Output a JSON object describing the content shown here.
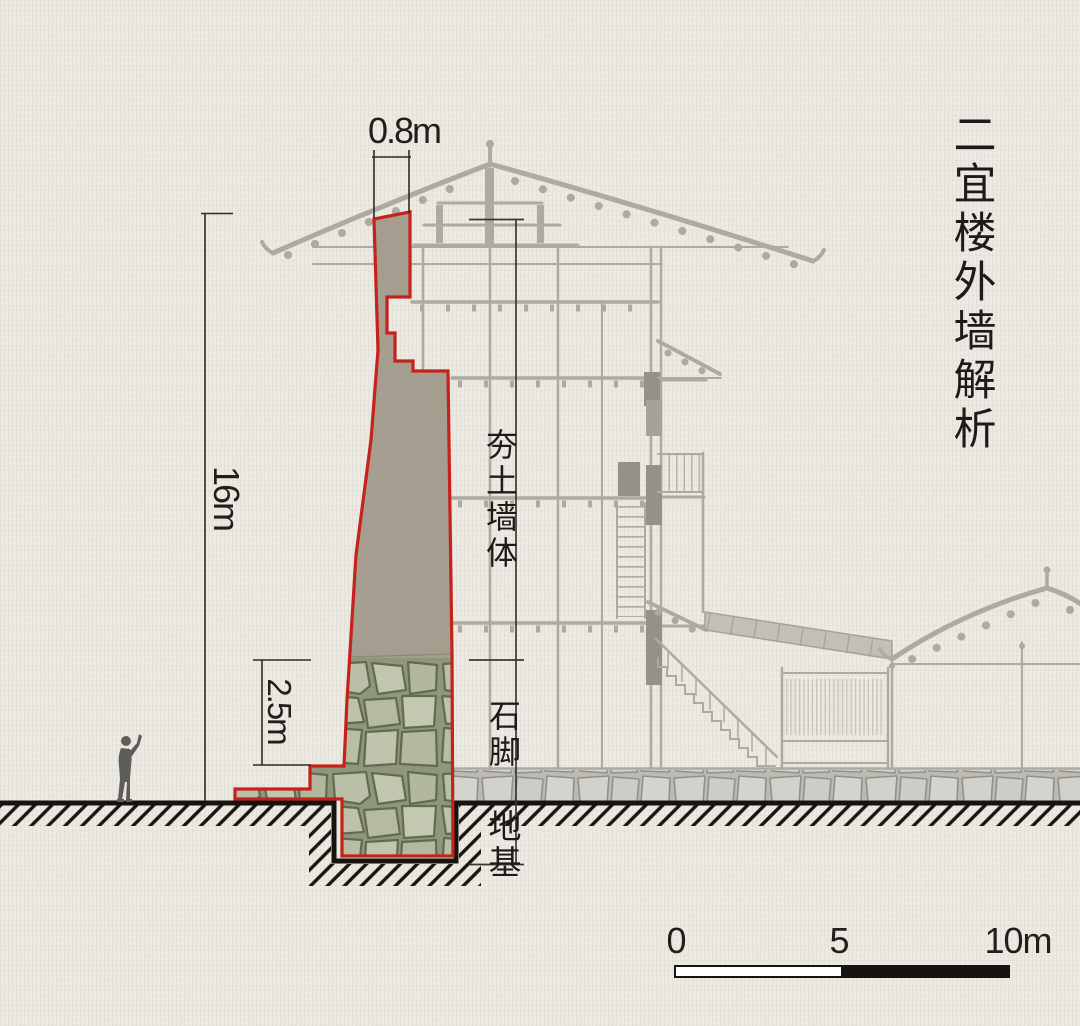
{
  "title": "二宜楼外墙解析",
  "wall": {
    "top_width": "0.8m",
    "height": "16m",
    "stone_foot_height": "2.5m",
    "layers": {
      "body": "夯土墙体",
      "foot": "石脚",
      "foundation": "地基"
    }
  },
  "scale_bar": {
    "start": "0",
    "middle": "5",
    "end": "10m"
  },
  "colors": {
    "outline_red": "#c7211b",
    "paper": "#efece6",
    "ink": "#22211d",
    "faded_drawing": "#adaaa1",
    "stone_fill": "#bcc2a9",
    "earth_fill": "#a8a192"
  }
}
